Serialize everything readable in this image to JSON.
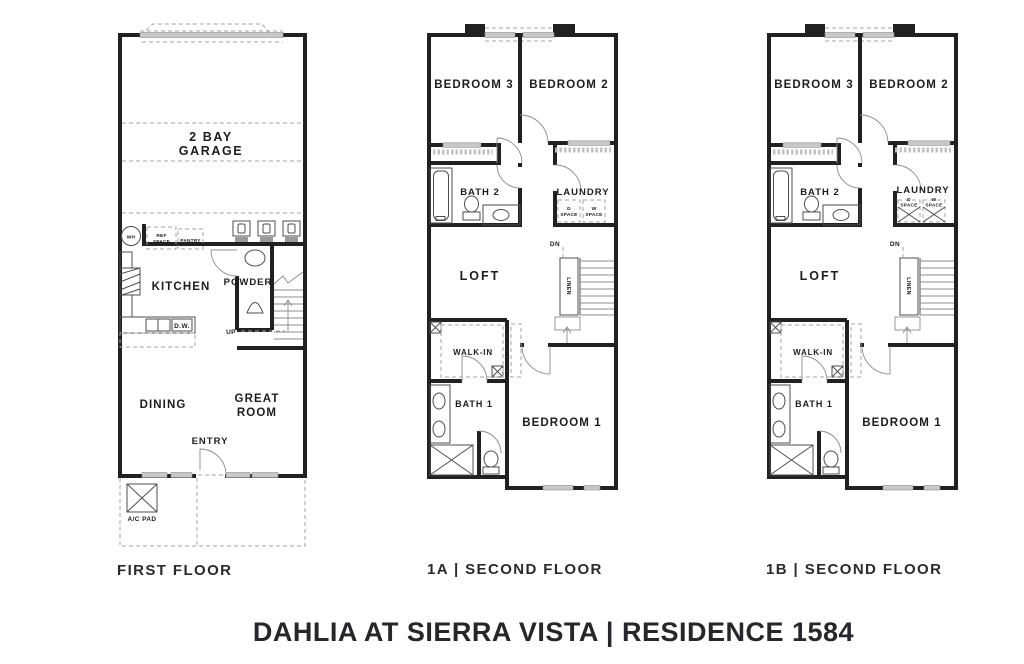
{
  "title": "DAHLIA AT SIERRA VISTA | RESIDENCE 1584",
  "colors": {
    "wall": "#212121",
    "window_fill": "#c8c8c8",
    "text": "#1d1d1d",
    "background": "#ffffff"
  },
  "plans": {
    "first": {
      "caption": "FIRST FLOOR",
      "garage_line1": "2 BAY",
      "garage_line2": "GARAGE",
      "kitchen": "KITCHEN",
      "powder": "POWDER",
      "dining": "DINING",
      "great_line1": "GREAT",
      "great_line2": "ROOM",
      "entry": "ENTRY",
      "up": "UP",
      "wh": "WH",
      "ref_line1": "REF",
      "ref_line2": "SPACE",
      "pantry": "PANTRY",
      "dw": "D.W.",
      "ac_pad": "A/C PAD"
    },
    "second_a": {
      "caption": "1A | SECOND FLOOR",
      "bedroom3": "BEDROOM 3",
      "bedroom2": "BEDROOM 2",
      "bath2": "BATH 2",
      "laundry": "LAUNDRY",
      "d_line1": "D",
      "d_line2": "SPACE",
      "w_line1": "W",
      "w_line2": "SPACE",
      "loft": "LOFT",
      "dn": "DN",
      "linen": "LINEN",
      "walk_in": "WALK-IN",
      "bath1": "BATH 1",
      "bedroom1": "BEDROOM 1"
    },
    "second_b": {
      "caption": "1B | SECOND FLOOR",
      "bedroom3": "BEDROOM 3",
      "bedroom2": "BEDROOM 2",
      "bath2": "BATH 2",
      "laundry": "LAUNDRY",
      "d_line1": "D",
      "d_line2": "SPACE",
      "w_line1": "W",
      "w_line2": "SPACE",
      "loft": "LOFT",
      "dn": "DN",
      "linen": "LINEN",
      "walk_in": "WALK-IN",
      "bath1": "BATH 1",
      "bedroom1": "BEDROOM 1"
    }
  }
}
